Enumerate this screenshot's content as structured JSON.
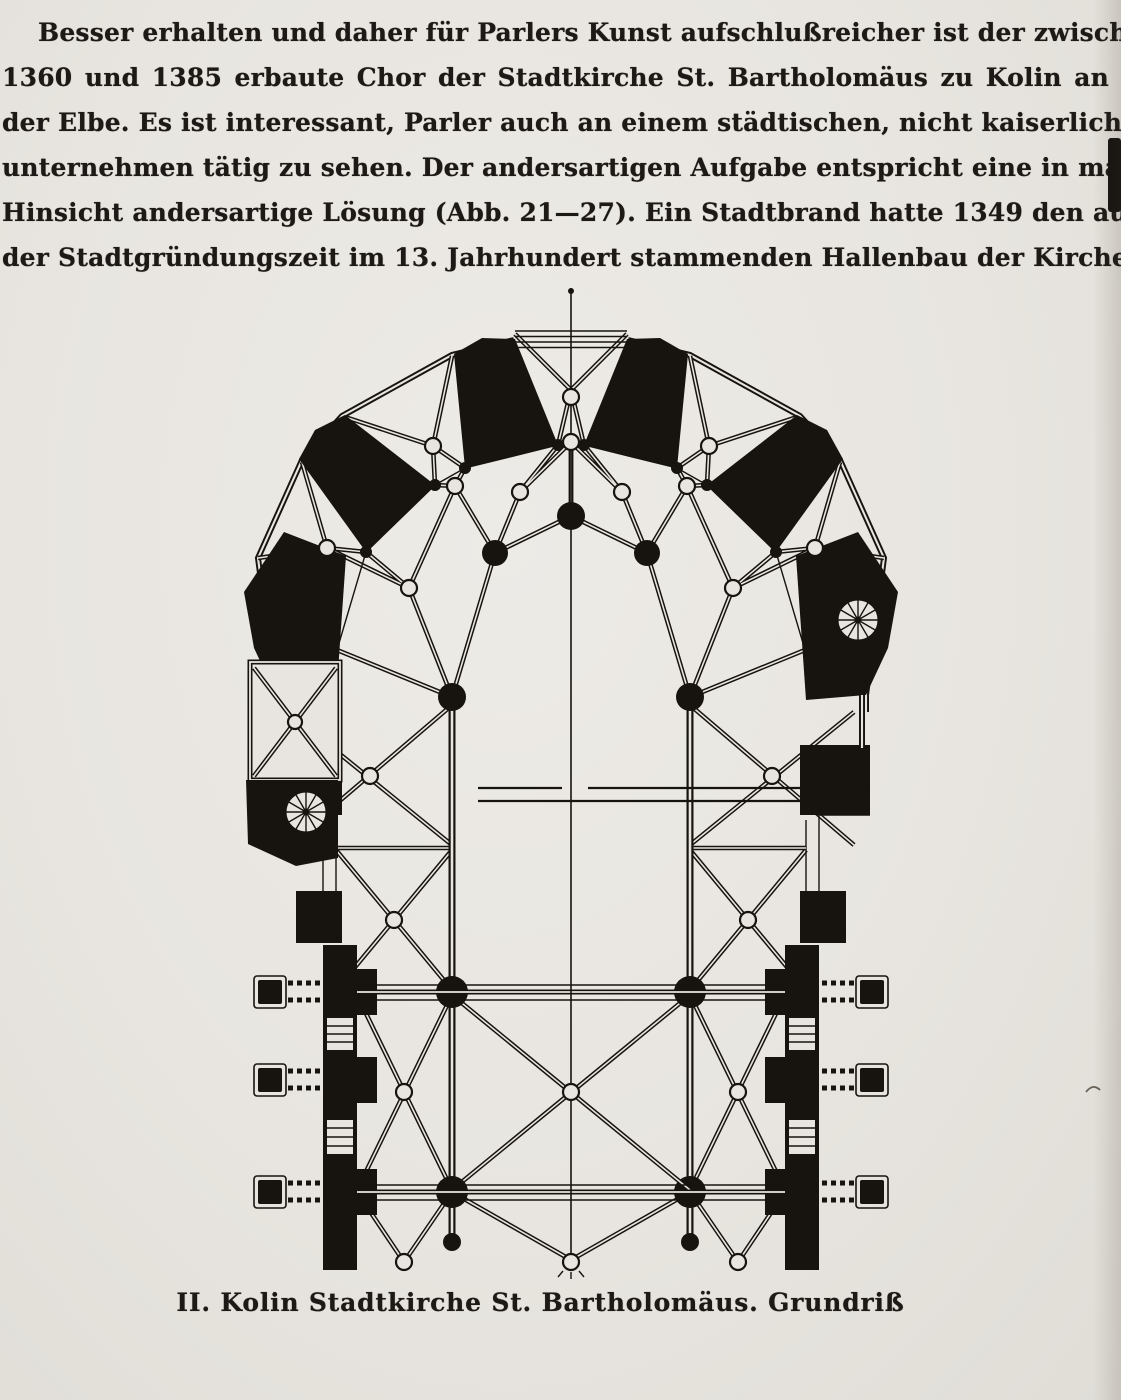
{
  "colors": {
    "paper": "#e8e5e0",
    "ink": "#1c1916"
  },
  "paragraph": {
    "lines": [
      "Besser erhalten und daher für Parlers Kunst aufschlußreicher ist der zwischen",
      "1360 und 1385 erbaute Chor der Stadtkirche St. Bartholomäus zu Kolin an",
      "der Elbe. Es ist interessant, Parler auch an einem städtischen, nicht kaiserlichen Bau=",
      "unternehmen tätig zu sehen. Der andersartigen Aufgabe entspricht eine in mancher",
      "Hinsicht andersartige Lösung (Abb. 21—27). Ein Stadtbrand hatte 1349 den aus",
      "der Stadtgründungszeit im 13. Jahrhundert stammenden Hallenbau der Kirche"
    ]
  },
  "figure": {
    "caption": "II. Kolin  Stadtkirche St. Bartholomäus. Grundriß"
  }
}
